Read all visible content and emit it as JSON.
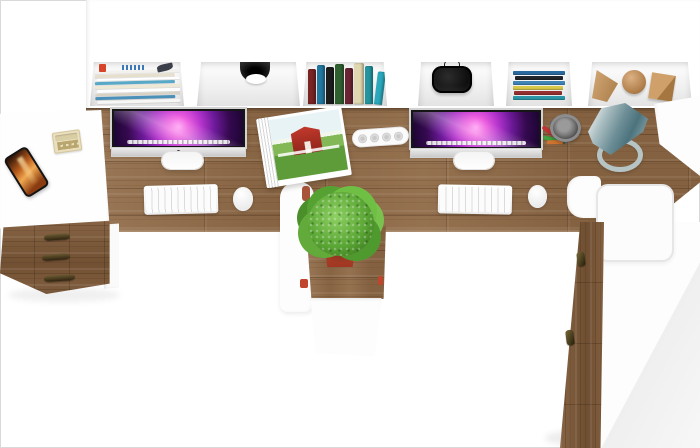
{
  "meta": {
    "kind": "product-photo",
    "subject": "Top-down view of a two-person white and oak office desk set with hutch, drawer cabinet, plant pedestal and wardrobe",
    "width": 700,
    "height": 448
  },
  "palette": {
    "bg": "#ffffff",
    "photo_border": "#d9d9d9",
    "wood": "#8e6946",
    "wood_dark": "#7b5737",
    "white_furniture": "#fdfdfd",
    "screen_pink": "#ef5fe0",
    "screen_purple": "#6d1a9a",
    "screen_dark": "#1a0530",
    "plant_green": "#5aa635",
    "pot_red": "#c0452c",
    "lamp_teal": "#5d828c",
    "handle_bronze": "#4a3a1e",
    "barn_red": "#c2392c"
  },
  "hutch": {
    "compartments": [
      {
        "item": "magazine-stack",
        "colors": [
          "#f2f1ed",
          "#e6dfcc",
          "#ffffff",
          "#58a8c8",
          "#efe8d5",
          "#ffffff",
          "#d9d1c1",
          "#4a90b8",
          "#f6f6f4"
        ]
      },
      {
        "item": "cable-grommet",
        "colors": []
      },
      {
        "item": "upright-books",
        "colors": [
          "#7a2424",
          "#2277a0",
          "#1d1d1d",
          "#2f6030",
          "#6b2433",
          "#e0d6b0",
          "#23959f",
          "#2aa8bc"
        ]
      },
      {
        "item": "headphones",
        "colors": []
      },
      {
        "item": "stacked-books",
        "colors": [
          "#2b6ca0",
          "#22262a",
          "#3f85b8",
          "#d8c84a",
          "#963030",
          "#2a96a8"
        ]
      },
      {
        "item": "wooden-decor-shapes",
        "colors": [
          "#c89a68"
        ]
      }
    ]
  },
  "workstations": [
    {
      "monitor": "imac-left",
      "wallpaper": "purple-galaxy",
      "accessories": [
        "white-keyboard",
        "white-mouse"
      ]
    },
    {
      "monitor": "imac-right",
      "wallpaper": "purple-galaxy",
      "accessories": [
        "white-keyboard",
        "white-mouse"
      ]
    }
  ],
  "desk_props": {
    "power_strip": {
      "socket_count": 4
    },
    "pencil_cup": {
      "pen_colors": [
        "#3fa03f",
        "#c23232",
        "#3a64c2",
        "#d8c231",
        "#2a2a2a",
        "#63b843",
        "#cf7430",
        "#2b8f9c"
      ]
    },
    "open_magazine": {
      "photo": "red-barn-with-lawn"
    },
    "desk_lamp": {
      "shade": "teal-cone",
      "base": "ring"
    },
    "plant": {
      "pot": "red-square"
    }
  },
  "left_cabinet": {
    "drawer_count": 3,
    "items_on_top": [
      "smartphone",
      "calculator"
    ]
  },
  "right_wardrobe": {
    "handle_count": 2
  }
}
